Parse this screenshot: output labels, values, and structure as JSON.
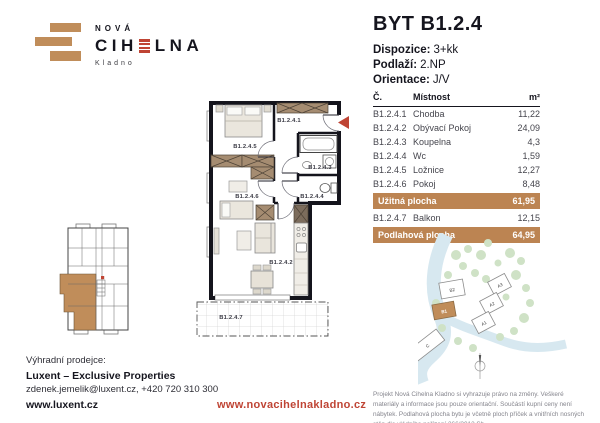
{
  "colors": {
    "brick": "#c08d5a",
    "red": "#bf4434",
    "dark": "#15151e",
    "tan_row": "#bc8452"
  },
  "logo": {
    "line1": "NOVÁ",
    "word_start": "CIH",
    "word_end": "LNA",
    "city": "Kladno"
  },
  "header": {
    "title": "BYT B1.2.4",
    "specs": [
      {
        "label": "Dispozice:",
        "value": "3+kk"
      },
      {
        "label": "Podlaží:",
        "value": "2.NP"
      },
      {
        "label": "Orientace:",
        "value": "J/V"
      }
    ]
  },
  "room_table": {
    "col_no": "Č.",
    "col_room": "Místnost",
    "col_area": "m²",
    "rows": [
      {
        "no": "B1.2.4.1",
        "room": "Chodba",
        "area": "11,22"
      },
      {
        "no": "B1.2.4.2",
        "room": "Obývací Pokoj",
        "area": "24,09"
      },
      {
        "no": "B1.2.4.3",
        "room": "Koupelna",
        "area": "4,3"
      },
      {
        "no": "B1.2.4.4",
        "room": "Wc",
        "area": "1,59"
      },
      {
        "no": "B1.2.4.5",
        "room": "Ložnice",
        "area": "12,27"
      },
      {
        "no": "B1.2.4.6",
        "room": "Pokoj",
        "area": "8,48"
      }
    ],
    "usable": {
      "label": "Užitná plocha",
      "value": "61,95"
    },
    "balcony": {
      "no": "B1.2.4.7",
      "room": "Balkon",
      "area": "12,15"
    },
    "total": {
      "label": "Podlahová plocha",
      "value": "64,95"
    }
  },
  "floorplan": {
    "labels": [
      "B1.2.4.1",
      "B1.2.4.2",
      "B1.2.4.3",
      "B1.2.4.4",
      "B1.2.4.5",
      "B1.2.4.6",
      "B1.2.4.7"
    ]
  },
  "siteplan": {
    "buildings": [
      {
        "label": "B2"
      },
      {
        "label": "B1"
      },
      {
        "label": "A3"
      },
      {
        "label": "A2"
      },
      {
        "label": "A1"
      },
      {
        "label": "C"
      }
    ]
  },
  "footer": {
    "seller_label": "Výhradní prodejce:",
    "seller_name": "Luxent – Exclusive Properties",
    "seller_contact": "zdenek.jemelik@luxent.cz, +420 720 310 300",
    "seller_web": "www.luxent.cz",
    "project_web": "www.novacihelnakladno.cz",
    "disclaimer": "Projekt Nová Cihelna Kladno si vyhrazuje právo na změny. Veškeré materiály a informace jsou pouze orientační. Součástí kupní ceny není nábytek. Podlahová plocha bytu je včetně ploch příček a vnitřních nosných stěn dle vládního nařízení 366/2013 Sb."
  }
}
